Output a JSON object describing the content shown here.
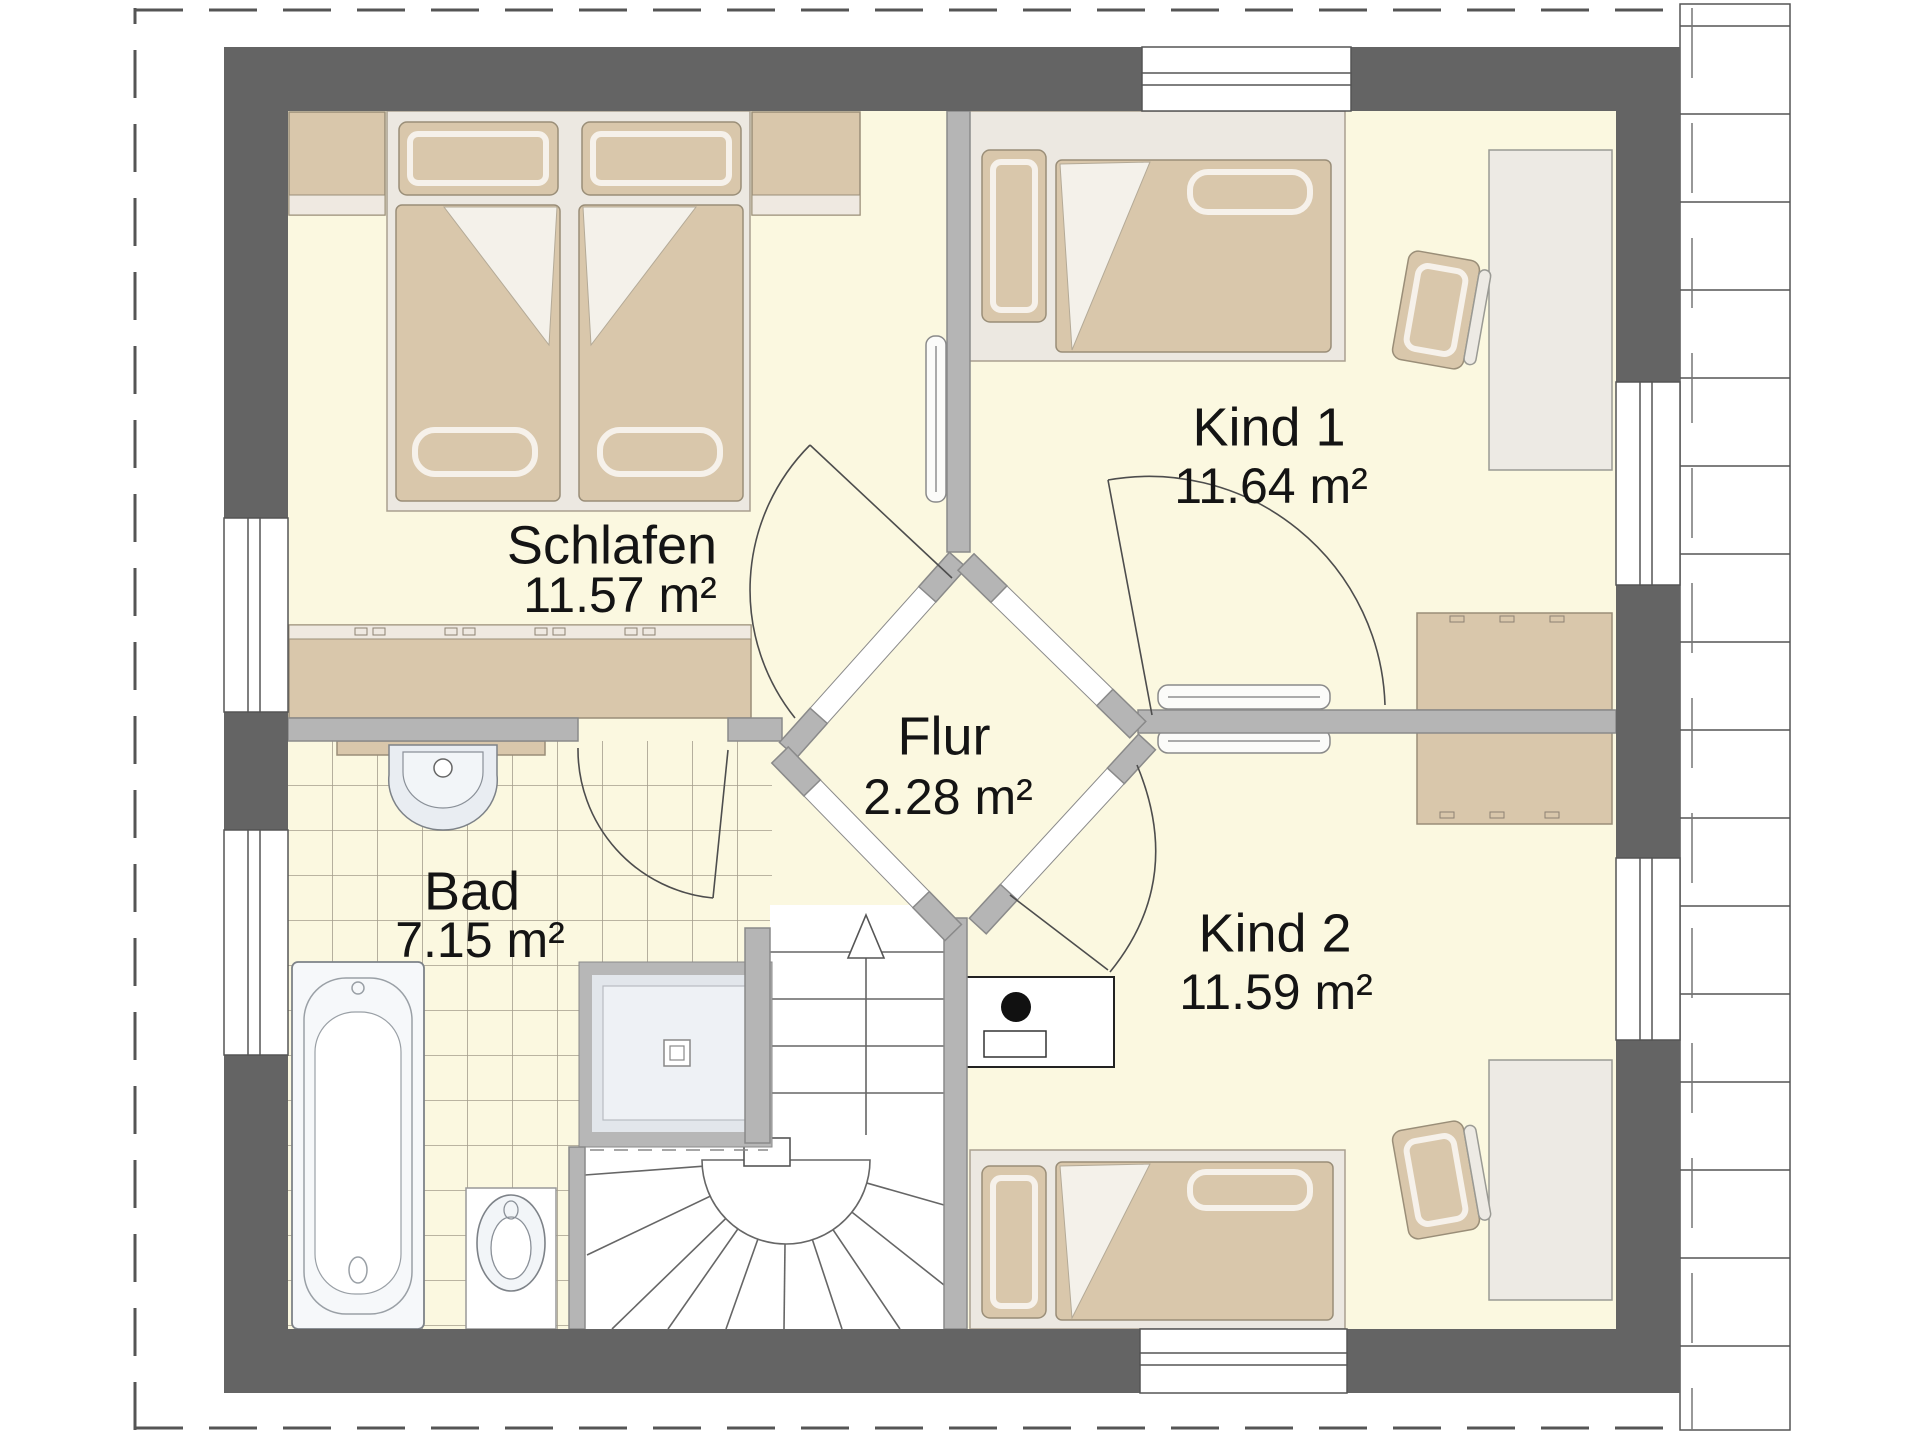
{
  "plan": {
    "rooms": [
      {
        "id": "schlafen",
        "name": "Schlafen",
        "area": "11.57 m²"
      },
      {
        "id": "kind1",
        "name": "Kind 1",
        "area": "11.64 m²"
      },
      {
        "id": "flur",
        "name": "Flur",
        "area": "2.28 m²"
      },
      {
        "id": "bad",
        "name": "Bad",
        "area": "7.15 m²"
      },
      {
        "id": "kind2",
        "name": "Kind 2",
        "area": "11.59 m²"
      }
    ],
    "colors": {
      "wall": "#646464",
      "innerWall": "#b5b5b5",
      "innerWallEdge": "#8a8a8a",
      "floor": "#FBF8E0",
      "tileLine": "#a49d8c",
      "furnitureTan": "#D9C7AB",
      "furnitureTanEdge": "#9a8e78",
      "bedBase": "#ECE8E1",
      "bedBaseEdge": "#a99f90",
      "deskFill": "#EDEAE4",
      "fixtureFill": "#E9EDF2",
      "showerFill": "#E2E6EB",
      "outline": "#555555",
      "textColor": "#141414"
    }
  }
}
